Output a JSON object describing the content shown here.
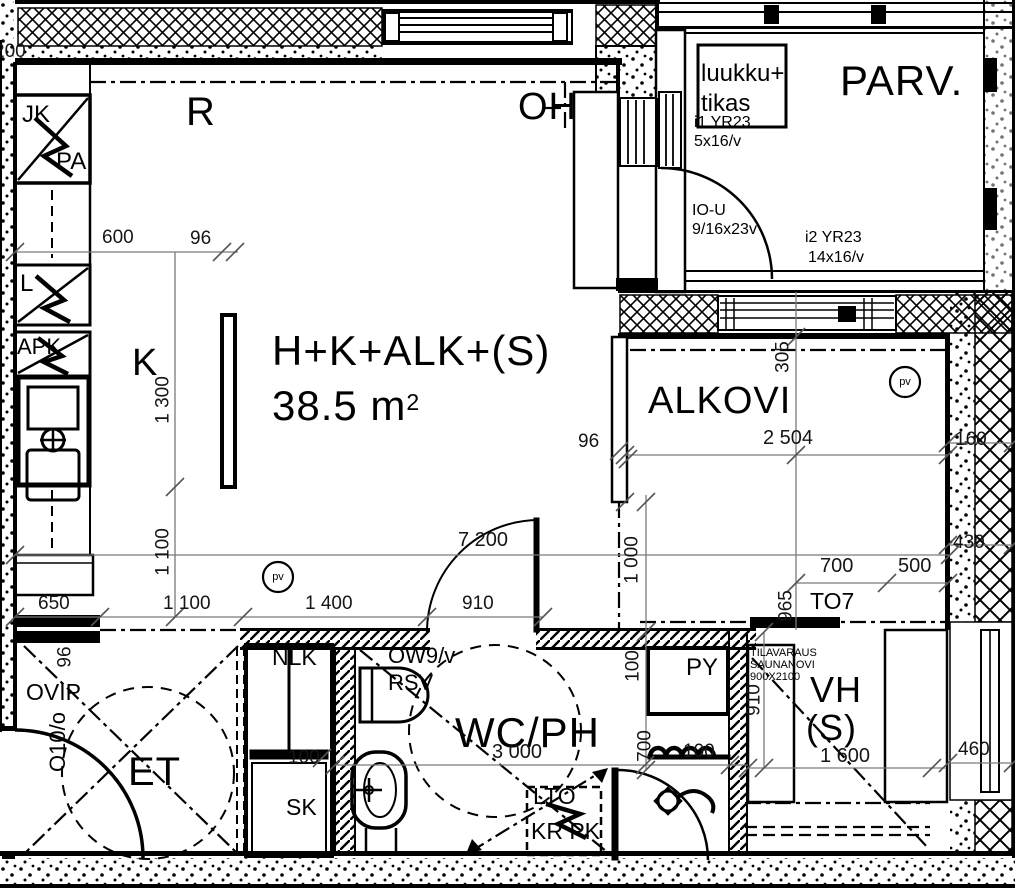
{
  "plan": {
    "rooms": {
      "dining": "R",
      "living": "OH",
      "kitchen": "K",
      "main_name": "H+K+ALK+(S)",
      "area": "38.5 m",
      "area_sup": "2",
      "balcony": "PARV.",
      "alcove": "ALKOVI",
      "entry": "ET",
      "bathroom": "WC/PH",
      "closet_line1": "VH",
      "closet_line2": "(S)"
    },
    "fixtures": {
      "fridge": "JK",
      "freezer": "PA",
      "stove": "L",
      "dishwasher": "APK",
      "door_phone": "OVIP",
      "coat_rack": "NLK",
      "cleaning_closet": "SK",
      "washer": "PY",
      "heat_recovery": "LTO",
      "dryer_washer": "KR PK"
    },
    "openings": {
      "entry_door": "O10/o",
      "balcony_hatch1": "luukku+",
      "balcony_hatch2": "tikas",
      "win1": "i1 YR23",
      "win1_size": "5x16/v",
      "balcony_door": "IO-U",
      "balcony_door_size": "9/16x23v",
      "win2": "i2 YR23",
      "win2_size": "14x16/v",
      "bath_door": "OW9/v",
      "bath_door_note": "RSV",
      "storage_door": "TO7"
    },
    "notes": {
      "sauna1": "TILAVARAUS",
      "sauna2": "SAUNANOVI",
      "sauna3": "900X2100"
    },
    "symbols": {
      "smoke_detector": "pv"
    },
    "dims": {
      "d200": "200",
      "d600": "600",
      "d96_top": "96",
      "d1300": "1 300",
      "d1100_v": "1 100",
      "d650": "650",
      "d1100": "1 100",
      "d1400": "1 400",
      "d910": "910",
      "d7200": "7 200",
      "d96_kitchen": "96",
      "d96_alcove": "96",
      "d2504": "2 504",
      "d305": "305",
      "d1000": "1 000",
      "d700_top": "700",
      "d500": "500",
      "d160": "160",
      "d430": "430",
      "d460": "460",
      "d3000": "3 000",
      "d100_wc": "100",
      "d700_wc": "700",
      "d100_closet": "100",
      "d100_rail": "100",
      "d965": "965",
      "d910_vh": "910",
      "d1600": "1 600"
    }
  }
}
